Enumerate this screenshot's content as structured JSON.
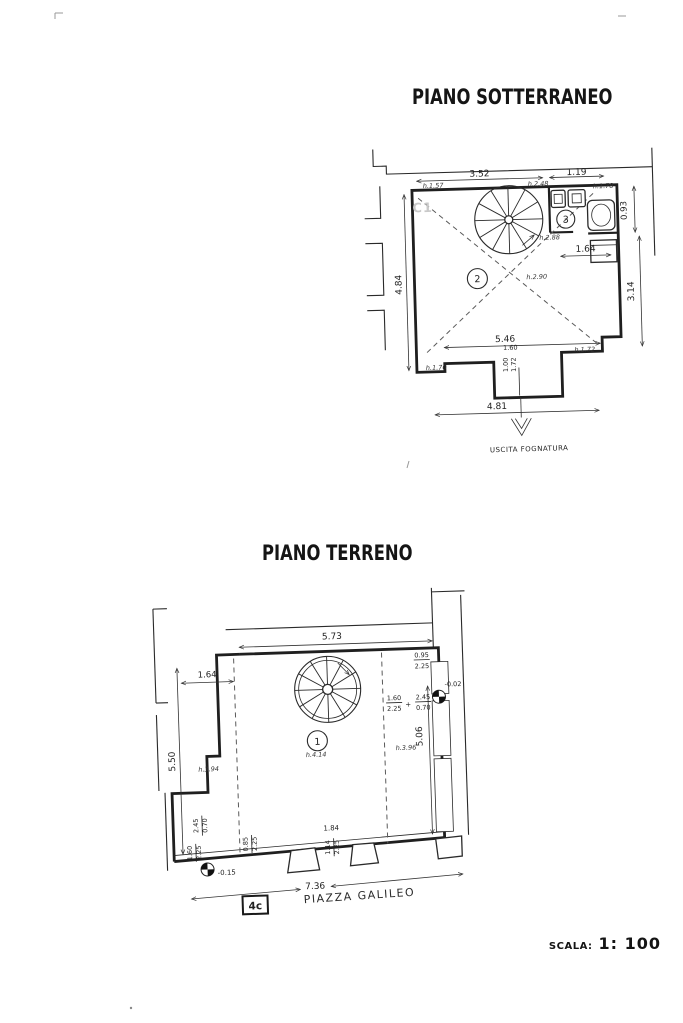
{
  "titles": {
    "basement": "PIANO SOTTERRANEO",
    "ground": "PIANO TERRENO"
  },
  "scale_bar": {
    "label": "SCALA:",
    "value": "1: 100"
  },
  "basement": {
    "stamp": "C1",
    "rooms": {
      "r2": "2",
      "r3": "3"
    },
    "dims": {
      "w_top": "3.52",
      "w_top_right": "1.19",
      "h_right_top": "0.93",
      "h_left": "4.84",
      "h_right": "3.14",
      "w_bath": "1.64",
      "w_inner": "5.46",
      "w_door": "1.60",
      "door_a": "1.00",
      "door_b": "1.72",
      "w_bottom": "4.81"
    },
    "heights": {
      "nw": "h.1.57",
      "stair_top": "h.2.48",
      "ne": "h.1.78",
      "stair_bottom": "h.2.88",
      "center": "h.2.90",
      "sw": "h.1.70",
      "se": "h.1.72"
    },
    "sewer_label": "USCITA FOGNATURA"
  },
  "ground": {
    "rooms": {
      "r1": "1"
    },
    "dims": {
      "w_top": "5.73",
      "w_upper_left": "1.64",
      "h_left": "5.50",
      "h_right": "5.06",
      "win_w": "0.95",
      "win_h": "2.25",
      "door_right_w": "1.60",
      "door_right_h": "2.25",
      "plus": "+",
      "opening_w": "2.45",
      "opening_h": "0.70",
      "f1_a": "2.45",
      "f1_b": "0.70",
      "f2_a": "1.60",
      "f2_b": "2.25",
      "f3_a": "0.85",
      "f3_b": "2.25",
      "door_mid_w": "1.84",
      "f4_a": "1.14",
      "f4_b": "2.25",
      "w_bottom": "7.36"
    },
    "heights": {
      "left": "h.3.94",
      "center": "h.4.14",
      "right": "h.3.96"
    },
    "levels": {
      "entry": "-0.02",
      "street": "-0.15"
    },
    "street_name": "PIAZZA GALILEO",
    "block_ref": "4c"
  }
}
